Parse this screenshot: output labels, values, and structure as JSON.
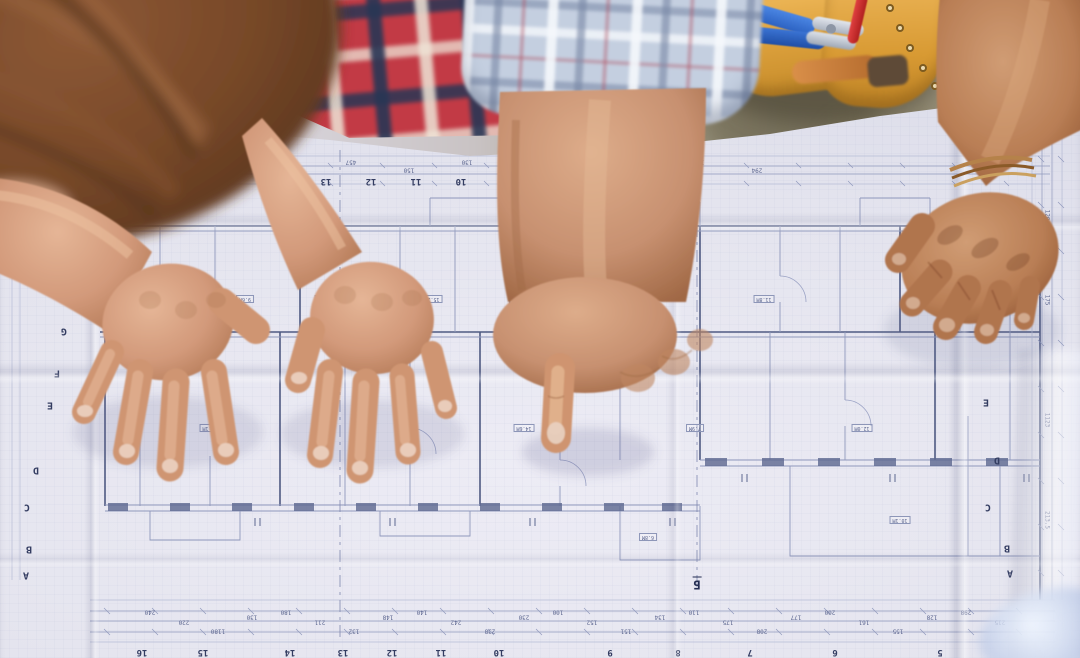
{
  "scene": {
    "description": "Overhead photograph of three construction workers around a folded architectural floor-plan blueprint on a table; one hand points at the plan",
    "people": [
      {
        "id": "left-worker",
        "label": "worker with brown hair leaning over the plan, both hands spread on the paper",
        "shirt": "red-navy plaid"
      },
      {
        "id": "center-worker",
        "label": "worker pointing at the plan with an index finger",
        "sleeve": "light blue plaid, rolled up"
      },
      {
        "id": "right-worker",
        "label": "worker wearing a tan leather tool belt, tanned hand resting on the plan",
        "accessory": "bracelet on wrist"
      }
    ],
    "objects": [
      {
        "id": "blueprint",
        "label": "folded architectural floor plan with dimension strips and grid markers"
      },
      {
        "id": "tool-belt",
        "label": "tan leather tool pouch with blue-handled pliers, red screwdriver and wooden-handled tool"
      },
      {
        "id": "glass-object",
        "label": "blurred glass object at bottom right corner"
      }
    ]
  },
  "palette": {
    "paper": "#e4e4ee",
    "plan_line": "#8f98bc",
    "plan_wall": "#4f5a82",
    "skin_light": "#d9a687",
    "skin_tan": "#c28e68",
    "skin_dark": "#b07650",
    "hair_brown": "#7b4b2d",
    "plaid_red": "#c23a45",
    "plaid_navy": "#2c3a59",
    "plaid_white": "#e9e2d6",
    "sleeve_blue": "#c4cfe0",
    "belt_leather": "#dda13c",
    "tool_blue": "#3671cf",
    "tool_red": "#c92f2f",
    "wood_handle": "#c07a3e",
    "ground_olive": "#8e8974"
  },
  "blueprint": {
    "grid_letters_left": [
      "H",
      "G",
      "F",
      "E",
      "D",
      "C",
      "B",
      "A"
    ],
    "grid_letters_right": [
      "E",
      "D",
      "C",
      "B",
      "A"
    ],
    "grid_numbers_top": [
      "14",
      "13",
      "12",
      "11",
      "10",
      "9",
      "8",
      "7",
      "6",
      "5"
    ],
    "grid_numbers_bottom": [
      "16",
      "15",
      "14",
      "13",
      "12",
      "11",
      "10",
      "9",
      "8",
      "7",
      "6",
      "5"
    ],
    "section_markers": [
      "Б",
      "Б"
    ],
    "dimensions_bottom": [
      "240",
      "220",
      "1180",
      "130",
      "180",
      "211",
      "132",
      "148",
      "140",
      "242",
      "238",
      "230",
      "100",
      "152",
      "151",
      "134",
      "110",
      "175",
      "208",
      "177",
      "200",
      "161",
      "155",
      "128",
      "298",
      "215"
    ],
    "dimensions_top": [
      "180",
      "240",
      "457",
      "150",
      "130",
      "244",
      "258",
      "152",
      "176",
      "294"
    ],
    "dimensions_right": [
      "110",
      "120",
      "175",
      "1123",
      "213.5"
    ],
    "room_labels": [
      "7.5М",
      "9.6М",
      "12.4М",
      "15.2М",
      "8.3М",
      "11.8М",
      "10.5М",
      "13.1М",
      "9.2М",
      "14.6М",
      "7.9М",
      "12.0М",
      "6.8М",
      "10.1М"
    ]
  }
}
